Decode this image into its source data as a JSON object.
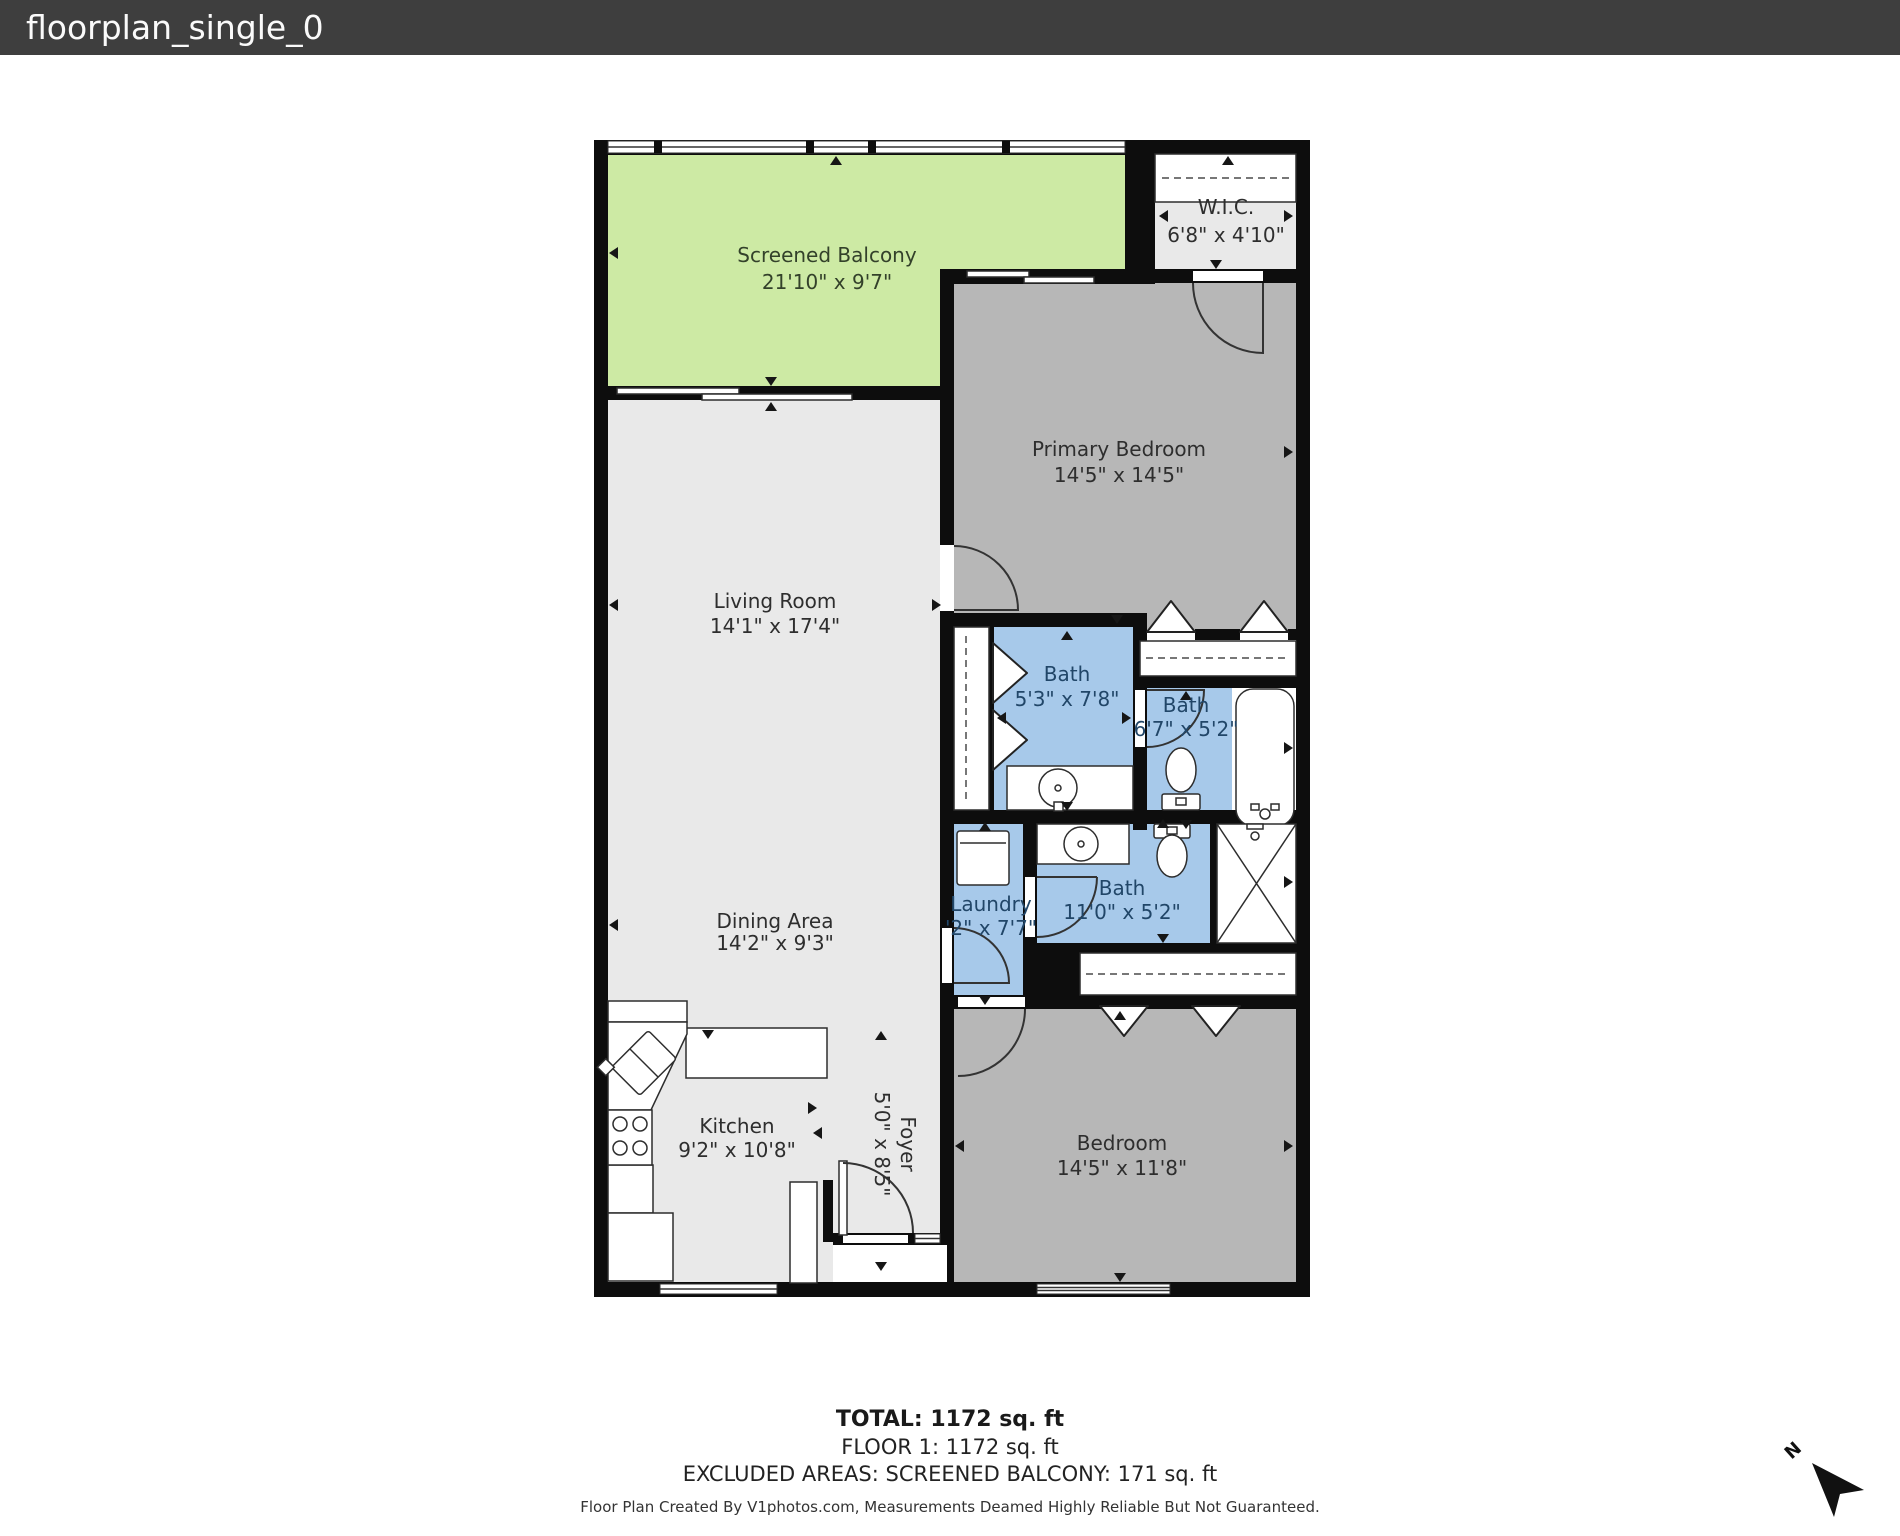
{
  "header": {
    "title": "floorplan_single_0"
  },
  "colors": {
    "header_bg": "#3e3e3e",
    "header_text": "#fafafa",
    "wall": "#0d0d0d",
    "room_light": "#e9e9e9",
    "room_gray": "#b7b7b7",
    "balcony_green": "#cdeaa4",
    "bath_blue": "#a7c9ea",
    "label_dark": "#2e2e2e",
    "label_bath": "#214668",
    "label_balcony": "#33412a",
    "fixture_stroke": "#2d2d2d"
  },
  "rooms": {
    "balcony": {
      "name": "Screened Balcony",
      "dims": "21'10\" x 9'7\""
    },
    "wic": {
      "name": "W.I.C.",
      "dims": "6'8\" x 4'10\""
    },
    "primary_bedroom": {
      "name": "Primary Bedroom",
      "dims": "14'5\" x 14'5\""
    },
    "living_room": {
      "name": "Living Room",
      "dims": "14'1\" x 17'4\""
    },
    "bath_1": {
      "name": "Bath",
      "dims": "5'3\" x 7'8\""
    },
    "bath_2": {
      "name": "Bath",
      "dims": "6'7\" x 5'2\""
    },
    "dining": {
      "name": "Dining Area",
      "dims": "14'2\" x 9'3\""
    },
    "laundry": {
      "name": "Laundry",
      "dims": "'2\" x 7'7\""
    },
    "bath_3": {
      "name": "Bath",
      "dims": "11'0\" x 5'2\""
    },
    "kitchen": {
      "name": "Kitchen",
      "dims": "9'2\" x 10'8\""
    },
    "foyer": {
      "name": "Foyer",
      "dims": "5'0\" x 8'5\""
    },
    "bedroom": {
      "name": "Bedroom",
      "dims": "14'5\" x 11'8\""
    }
  },
  "summary": {
    "total": "TOTAL: 1172 sq. ft",
    "floor1": "FLOOR 1: 1172 sq. ft",
    "excluded": "EXCLUDED AREAS: SCREENED BALCONY: 171 sq. ft"
  },
  "footer": {
    "credit": "Floor Plan Created By V1photos.com, Measurements Deamed Highly Reliable But Not Guaranteed."
  },
  "compass": {
    "label": "N"
  }
}
